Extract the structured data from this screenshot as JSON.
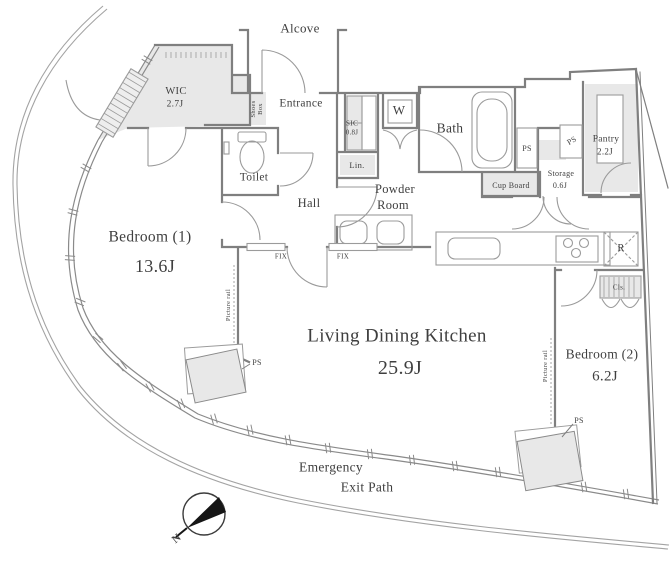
{
  "plan": {
    "alcove": "Alcove",
    "entrance": "Entrance",
    "shoes_box": {
      "line1": "Shoes",
      "line2": "Box"
    },
    "wic": {
      "name": "WIC",
      "size": "2.7J"
    },
    "sic": {
      "name": "SIC",
      "size": "0.8J"
    },
    "washer": "W",
    "bath": "Bath",
    "toilet": "Toilet",
    "hall": "Hall",
    "linen": "Lin.",
    "powder": {
      "line1": "Powder",
      "line2": "Room"
    },
    "ps": "PS",
    "cup_board": "Cup Board",
    "storage": {
      "name": "Storage",
      "size": "0.6J"
    },
    "pantry": {
      "name": "Pantry",
      "size": "2.2J"
    },
    "refrigerator": "R",
    "closet": "Cls.",
    "fix": "FIX",
    "picture_rail": "Picture rail",
    "bedroom1": {
      "name": "Bedroom (1)",
      "size": "13.6J"
    },
    "bedroom2": {
      "name": "Bedroom (2)",
      "size": "6.2J"
    },
    "ldk": {
      "name": "Living Dining Kitchen",
      "size": "25.9J"
    },
    "emergency": {
      "line1": "Emergency",
      "line2": "Exit Path"
    },
    "compass": {
      "north": "N"
    }
  },
  "colors": {
    "background": "#ffffff",
    "wall": "#7f7f7f",
    "thin_line": "#a3a3a3",
    "shade": "#e8e8e8",
    "text": "#3f3f3f",
    "compass": "#161616"
  }
}
